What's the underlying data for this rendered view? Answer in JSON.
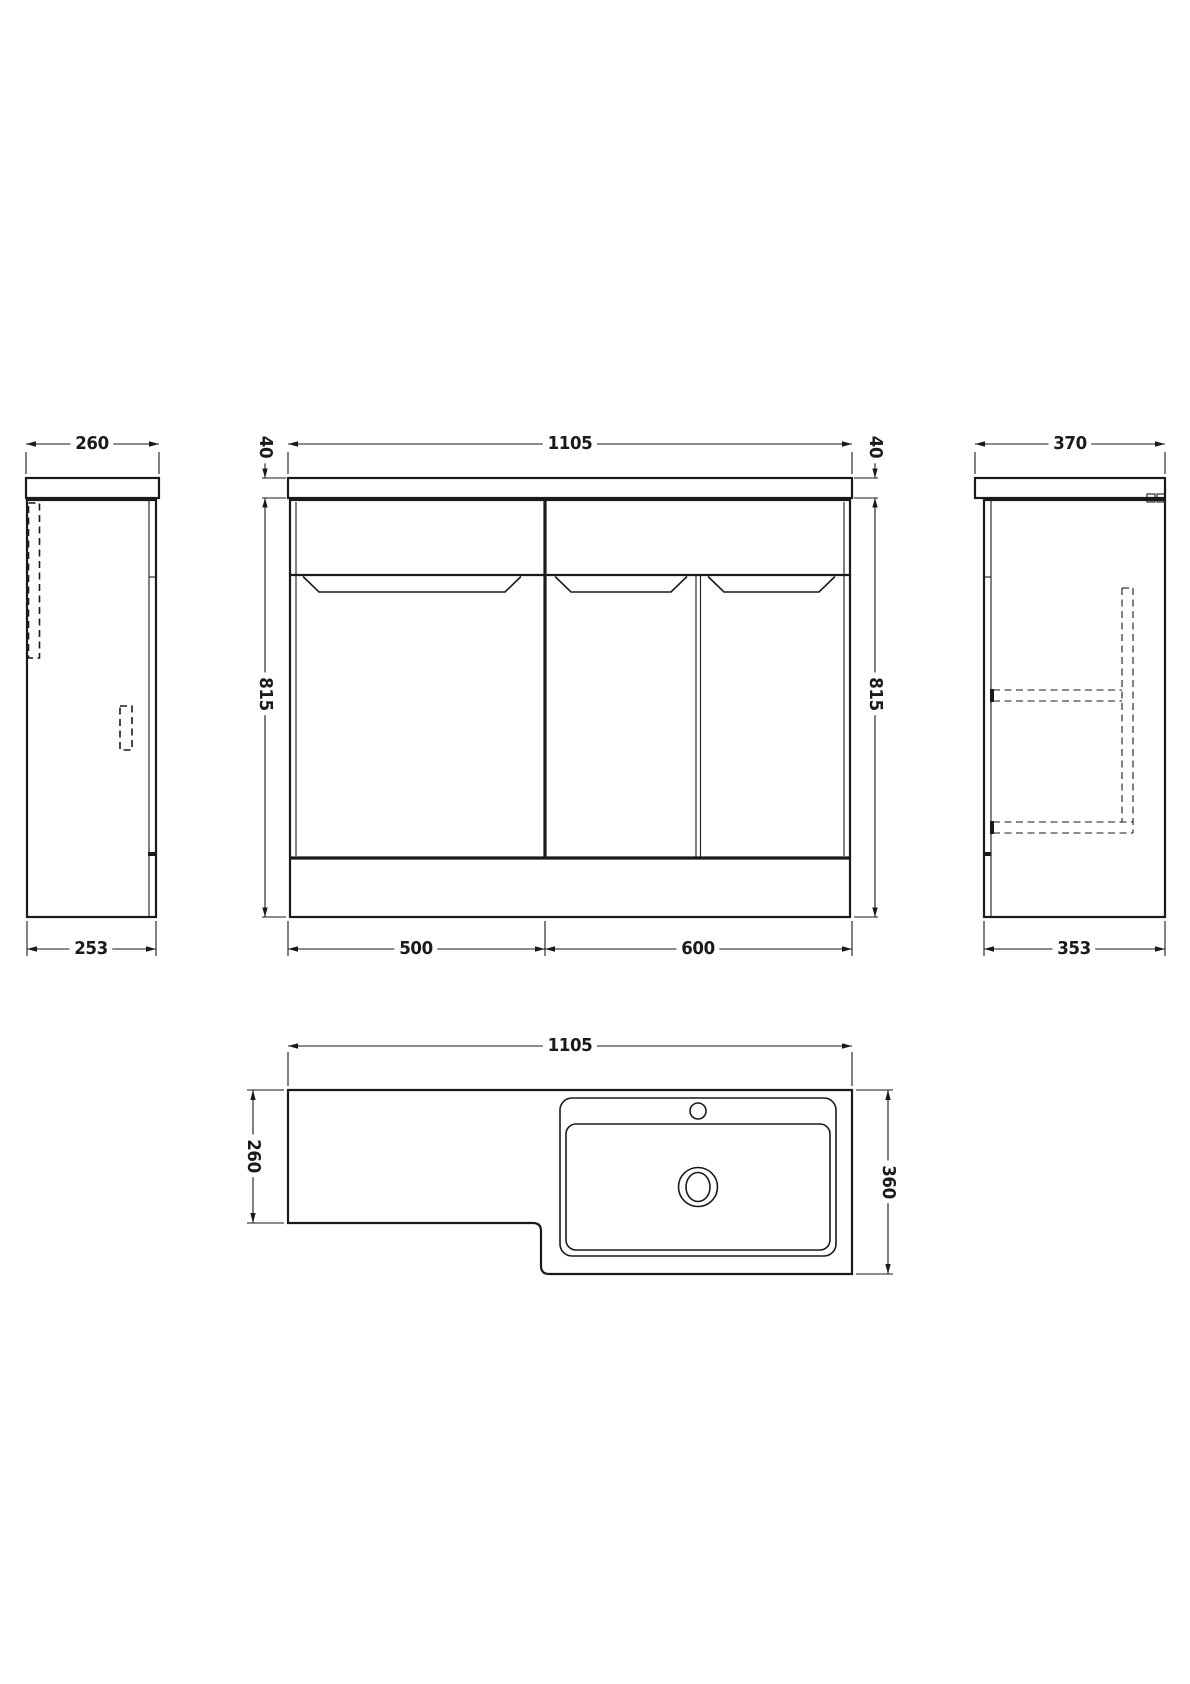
{
  "drawing_type": "vanity-unit-technical-drawing",
  "colors": {
    "line": "#1a1a1a",
    "background": "#ffffff"
  },
  "dims": {
    "side_left_top": "260",
    "side_left_bottom": "253",
    "front_width": "1105",
    "front_thickness_left": "40",
    "front_thickness_right": "40",
    "front_height_left": "815",
    "front_height_right": "815",
    "front_section_left": "500",
    "front_section_right": "600",
    "side_right_top": "370",
    "side_right_bottom": "353",
    "plan_width": "1105",
    "plan_depth_left": "260",
    "plan_depth_right": "360"
  }
}
